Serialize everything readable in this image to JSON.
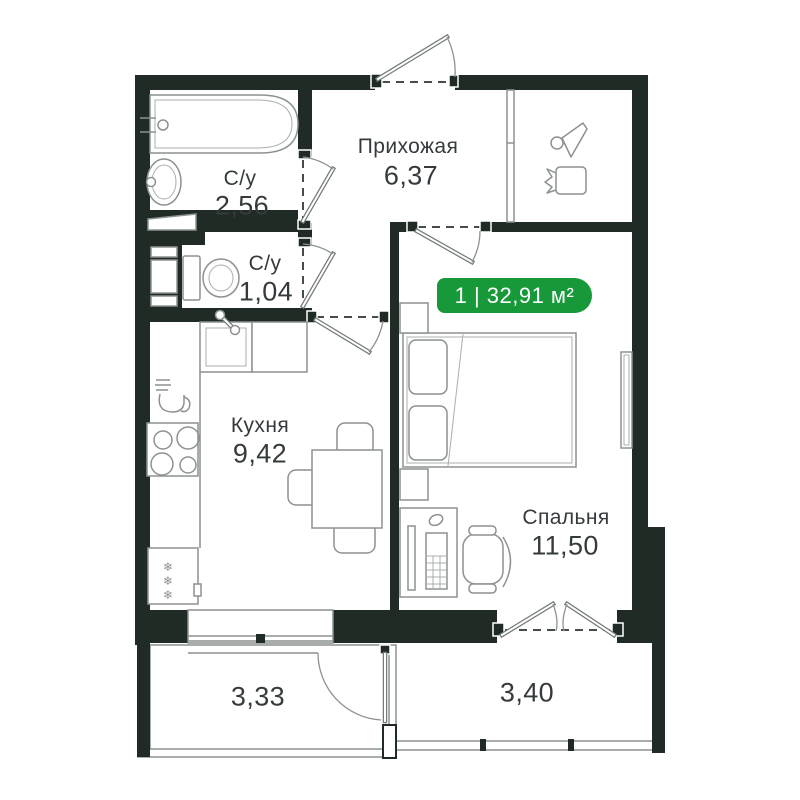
{
  "plan": {
    "badge": {
      "label": "1 | 32,91 м²"
    },
    "rooms": {
      "hallway": {
        "name": "Прихожая",
        "area": "6,37"
      },
      "bathroom": {
        "name": "С/у",
        "area": "2,56"
      },
      "wc": {
        "name": "С/у",
        "area": "1,04"
      },
      "kitchen": {
        "name": "Кухня",
        "area": "9,42"
      },
      "bedroom": {
        "name": "Спальня",
        "area": "11,50"
      },
      "balcony_left": {
        "area": "3,33"
      },
      "balcony_right": {
        "area": "3,40"
      }
    },
    "icons": {
      "snowflake": "❄"
    },
    "colors": {
      "wall": "#212b25",
      "accent": "#17993a",
      "line": "#8c9290",
      "label": "#353b3d"
    }
  }
}
